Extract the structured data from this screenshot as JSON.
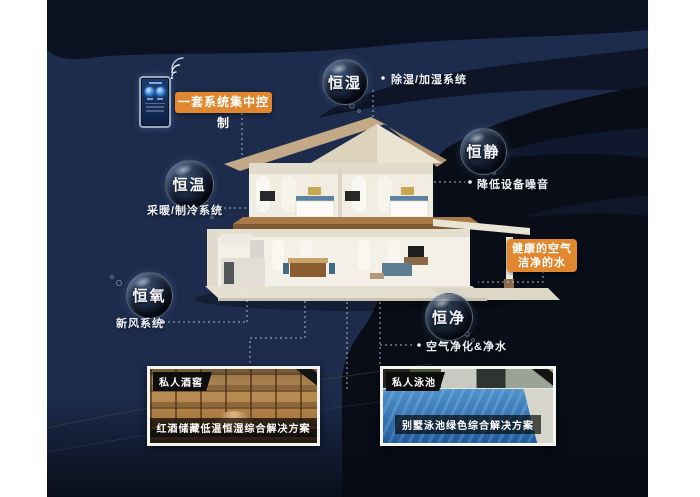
{
  "bubbles": [
    {
      "id": "humidity",
      "label": "恒湿"
    },
    {
      "id": "quiet",
      "label": "恒静"
    },
    {
      "id": "temperature",
      "label": "恒温"
    },
    {
      "id": "oxygen",
      "label": "恒氧"
    },
    {
      "id": "purity",
      "label": "恒净"
    }
  ],
  "system_labels": {
    "dehumidify": "除湿/加湿系统",
    "noise": "降低设备噪音",
    "heating": "采暖/制冷系统",
    "fresh_air": "新风系统",
    "purification": "空气净化&净水"
  },
  "callouts": {
    "central_control": "一套系统集中控制",
    "healthy_air_line1": "健康的空气",
    "healthy_air_line2": "洁净的水"
  },
  "cards": [
    {
      "tag": "私人酒窖",
      "caption": "红酒储藏低温恒湿综合解决方案"
    },
    {
      "tag": "私人泳池",
      "caption": "别墅泳池绿色综合解决方案"
    }
  ],
  "icons": {
    "wifi": "wifi-icon"
  },
  "colors": {
    "accent_orange": "#e0872f",
    "background_navy": "#1d2b4c",
    "deep_black": "#080d17",
    "card_frame": "#f4f4f1"
  }
}
